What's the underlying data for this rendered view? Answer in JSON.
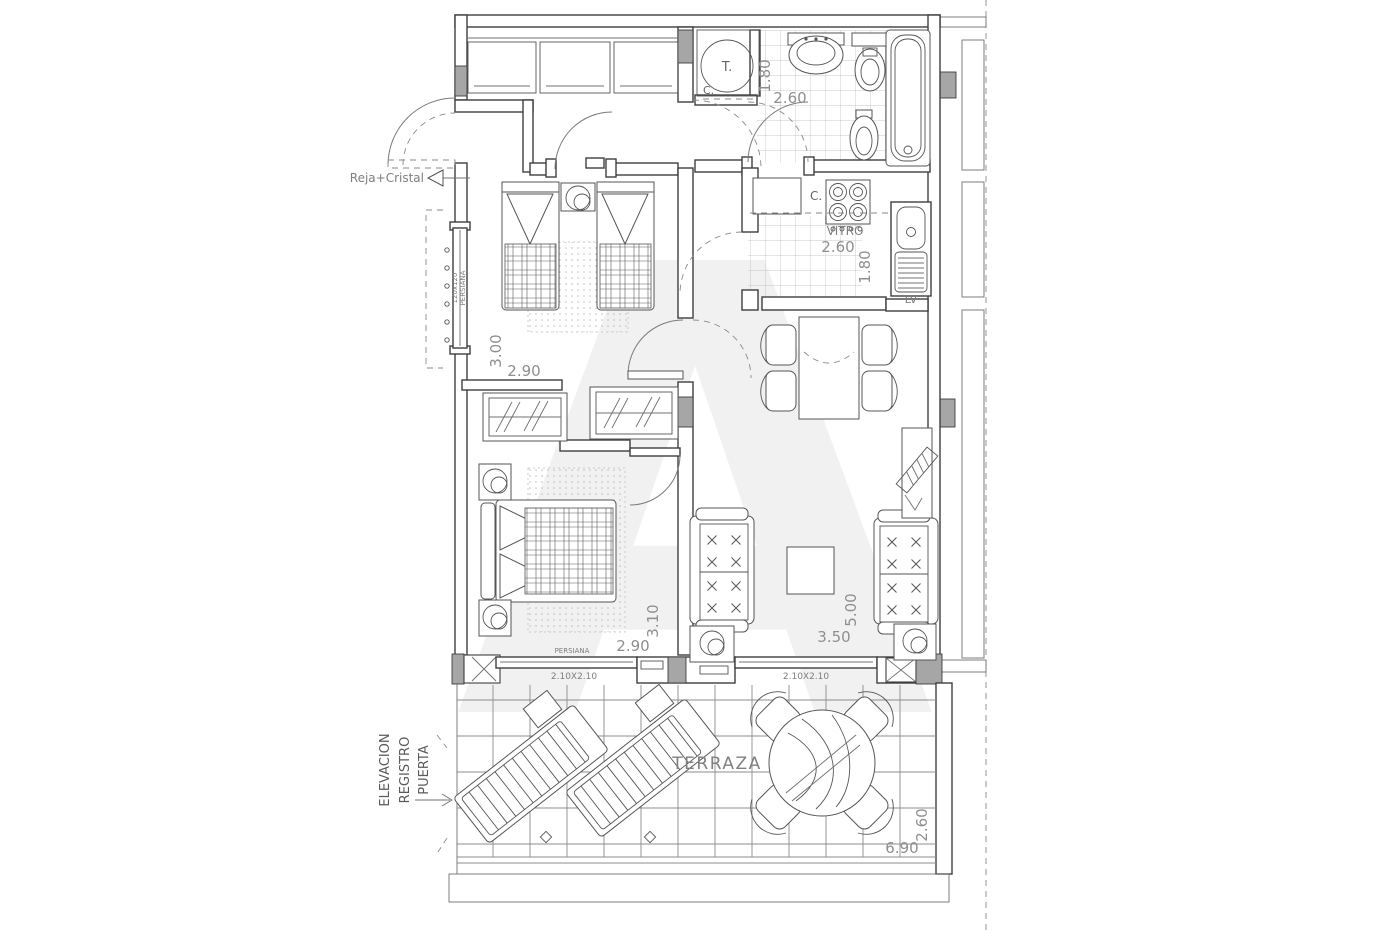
{
  "plan": {
    "annotations": {
      "reja_cristal": "Reja+Cristal",
      "elevacion": [
        "ELEVACION",
        "REGISTRO",
        "PUERTA"
      ],
      "window_left": [
        "120x120",
        "PERSIANA"
      ],
      "persiana_bottom": "PERSIANA",
      "window_bottom_left_size": "2.10X2.10",
      "window_bottom_right_size": "2.10X2.10",
      "watermark": "A"
    },
    "rooms": {
      "terrace_label": "TERRAZA",
      "kitchen_hob_label": "VITRO",
      "kitchen_counter_label": "C.",
      "kitchen_sink_label": "LV",
      "boiler_label": "T.",
      "boiler_sub_label": "C."
    },
    "dimensions": {
      "bath_depth": "1.80",
      "bath_width": "2.60",
      "kitchen_width": "2.60",
      "kitchen_depth": "1.80",
      "bedroom1_depth": "3.00",
      "bedroom1_width": "2.90",
      "bedroom2_depth": "3.10",
      "bedroom2_width": "2.90",
      "living_depth": "5.00",
      "living_width": "3.50",
      "terrace_depth": "2.60",
      "terrace_width": "6.90"
    }
  }
}
